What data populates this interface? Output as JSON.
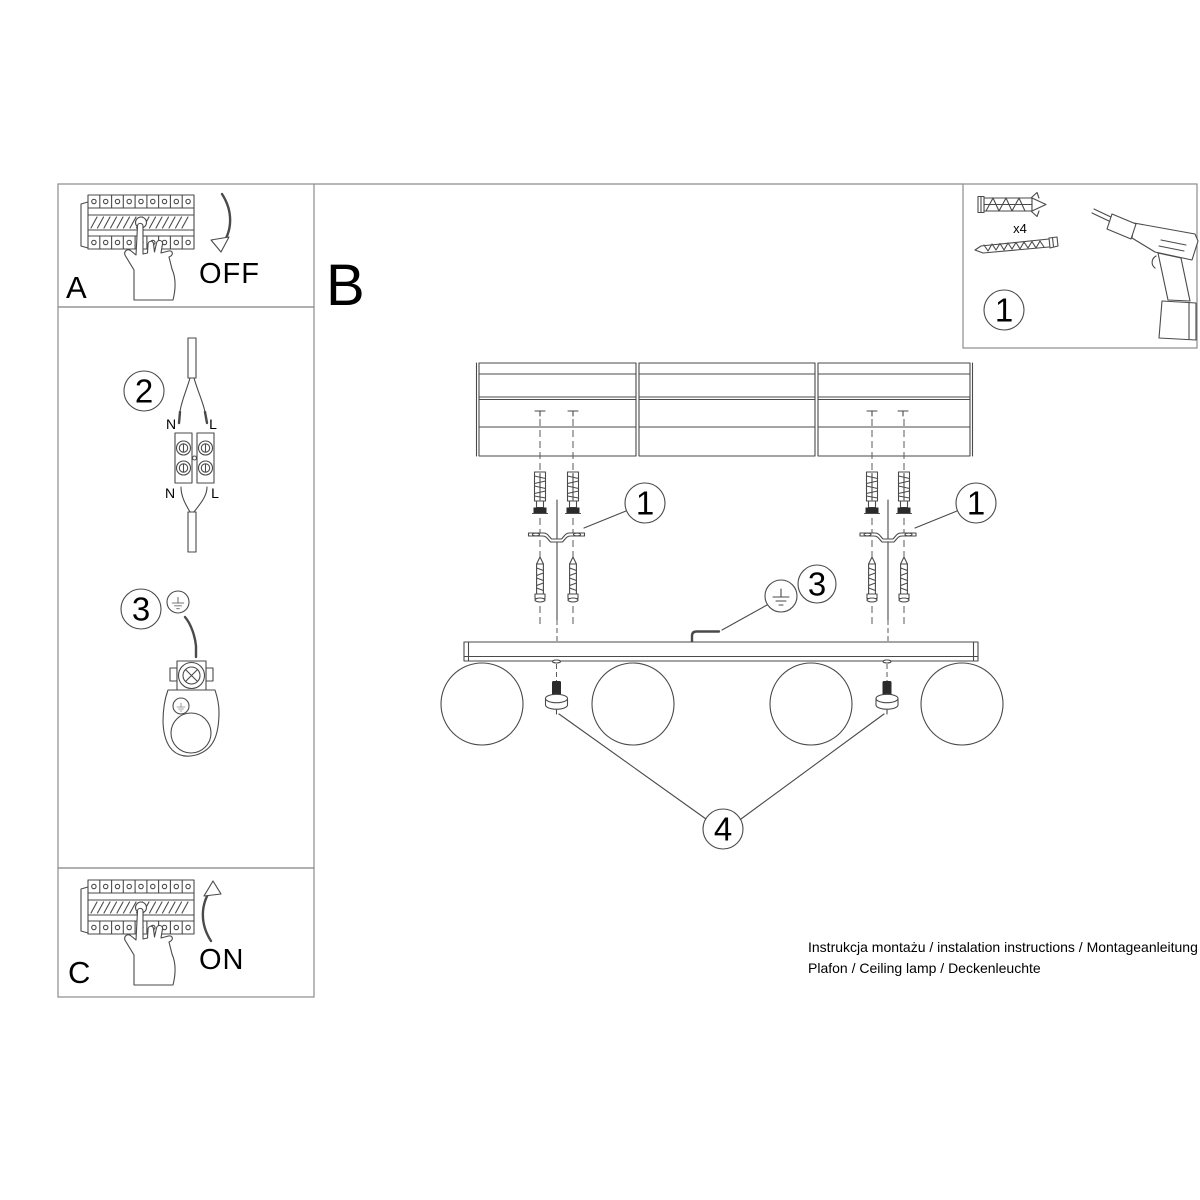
{
  "colors": {
    "background": "#ffffff",
    "drawing_line": "#4a4a4a",
    "frame_line": "#8c8c8c",
    "text": "#000000",
    "dark_fill": "#2b2b2b"
  },
  "steps": {
    "a": "A",
    "b": "B",
    "c": "C",
    "off": "OFF",
    "on": "ON"
  },
  "callouts": {
    "n1": "1",
    "n2": "2",
    "n3": "3",
    "n4": "4"
  },
  "wiring": {
    "n_top": "N",
    "l_top": "L",
    "n_bottom": "N",
    "l_bottom": "L"
  },
  "parts": {
    "anchor_qty": "x4"
  },
  "footer": {
    "line1": "Instrukcja montażu / instalation instructions / Montageanleitung",
    "line2": "Plafon / Ceiling lamp / Deckenleuchte"
  }
}
